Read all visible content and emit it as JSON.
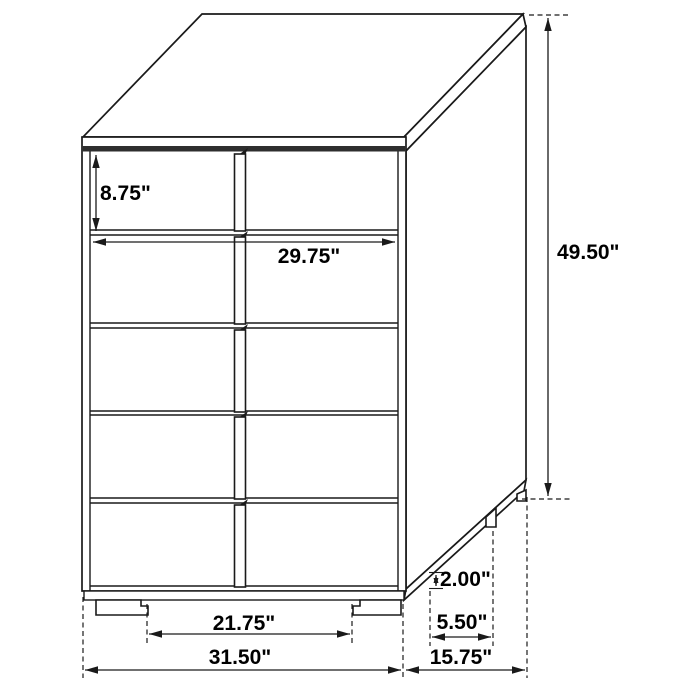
{
  "page": {
    "background": "#ffffff",
    "line_color": "#1a1a1a"
  },
  "diagram": {
    "subject": "5-drawer chest",
    "view": "three-quarter technical line drawing with dimension callouts",
    "unit": "inches",
    "drawer_rows": 5
  },
  "dimensions": {
    "drawer_height": {
      "label": "8.75\"",
      "value": 8.75,
      "measures": "top drawer front height"
    },
    "drawer_width": {
      "label": "29.75\"",
      "value": 29.75,
      "measures": "drawer front width"
    },
    "overall_height": {
      "label": "49.50\"",
      "value": 49.5,
      "measures": "overall height"
    },
    "base_height": {
      "label": "2.00\"",
      "value": 2.0,
      "measures": "base / foot height"
    },
    "foot_inset": {
      "label": "5.50\"",
      "value": 5.5,
      "measures": "side foot spacing"
    },
    "foot_span": {
      "label": "21.75\"",
      "value": 21.75,
      "measures": "clearance between front feet"
    },
    "overall_width": {
      "label": "31.50\"",
      "value": 31.5,
      "measures": "overall width"
    },
    "overall_depth": {
      "label": "15.75\"",
      "value": 15.75,
      "measures": "overall depth"
    }
  }
}
